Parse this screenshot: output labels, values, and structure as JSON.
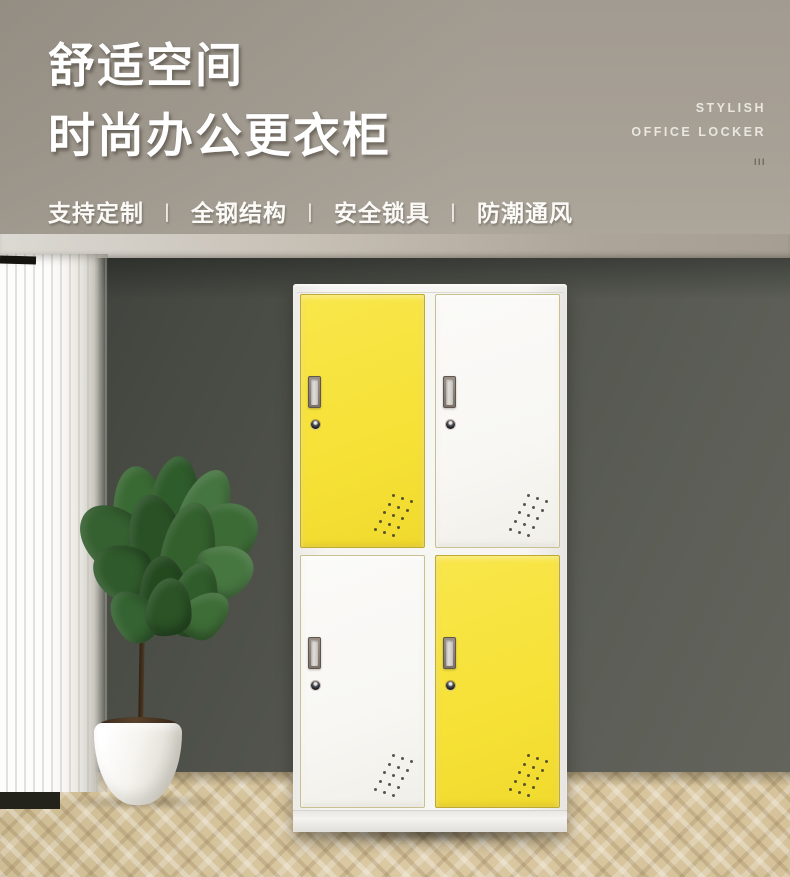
{
  "header": {
    "title_line1": "舒适空间",
    "title_line2": "时尚办公更衣柜",
    "features": [
      "支持定制",
      "全钢结构",
      "安全锁具",
      "防潮通风"
    ],
    "feature_separator": "丨",
    "english_tagline_line1": "STYLISH",
    "english_tagline_line2": "OFFICE LOCKER",
    "tick_marks": "III"
  },
  "scene": {
    "locker": {
      "rows": 2,
      "columns": 2,
      "doors": [
        {
          "position": "top-left",
          "color_name": "yellow"
        },
        {
          "position": "top-right",
          "color_name": "white"
        },
        {
          "position": "bottom-left",
          "color_name": "white"
        },
        {
          "position": "bottom-right",
          "color_name": "yellow"
        }
      ]
    },
    "props": [
      "white-sheer-curtain",
      "fiddle-leaf-fig-plant",
      "white-planter-pot",
      "herringbone-wood-floor",
      "dark-gray-wall"
    ]
  },
  "colors": {
    "accent_yellow": "#f6e136",
    "door_white": "#f8f7f3",
    "header_background": "#a29b90",
    "wall": "#52544d",
    "floor_wood": "#d8c7a3",
    "title_text": "#ffffff"
  }
}
